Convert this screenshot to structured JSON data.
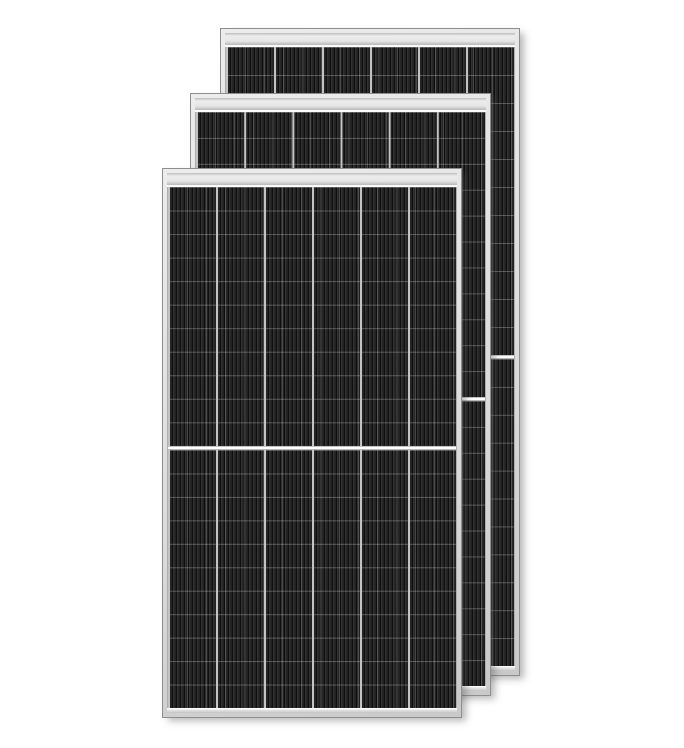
{
  "scene": {
    "description": "Product photograph of three framed monocrystalline half-cut-cell solar photovoltaic panels, stacked front to back in a staggered arrangement on a plain white background. No text, labels or watermarks are visible.",
    "background_color": "#ffffff",
    "panel_count": 3
  },
  "panels": [
    {
      "name": "back-solar-panel",
      "left": 220,
      "top": 28,
      "width": 300,
      "height": 648,
      "z": 1
    },
    {
      "name": "middle-solar-panel",
      "left": 190,
      "top": 93,
      "width": 301,
      "height": 603,
      "z": 2
    },
    {
      "name": "front-solar-panel",
      "left": 162,
      "top": 168,
      "width": 300,
      "height": 550,
      "z": 3
    }
  ],
  "panel_design": {
    "frame_color": "#dcdcdc",
    "frame_edge_color": "#8e8e8e",
    "top_band_color": "#e6e6e6",
    "cell_color": "#242424",
    "finger_line_color": "#0e0e0e",
    "column_divider_color": "#c3c3c3",
    "center_divider_color": "#ffffff",
    "columns": 6,
    "rows_per_half": 11,
    "halves_per_panel": 2
  }
}
